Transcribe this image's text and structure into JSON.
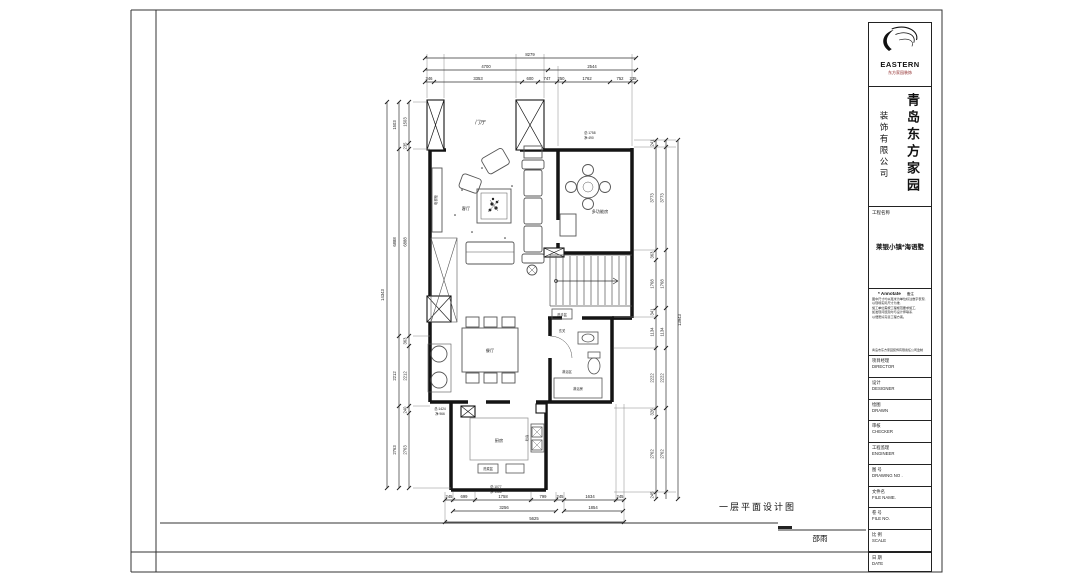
{
  "title_block": {
    "logo": {
      "brand": "EASTERN",
      "sub": "东方家园装饰"
    },
    "company": {
      "name_vertical": "青岛东方家园",
      "type_vertical": "装饰有限公司"
    },
    "project": {
      "label": "工程名称",
      "name": "莱银小镇*海语墅"
    },
    "annotate": {
      "header": "* Annotate",
      "header_right": "备注",
      "lines": [
        "图中尺寸均以毫米为单位标注数字表现,",
        "以现场实际尺寸为准,",
        "施工单位需按工程规范要求施工,",
        "如发现问题及时与设计师联系,",
        "以便更好完善工程方案。"
      ],
      "footer": "青岛市东方家园装饰有限责任公司监制"
    },
    "fields": [
      {
        "zh": "项目经理",
        "en": "DIRECTOR"
      },
      {
        "zh": "设计",
        "en": "DESIGNER"
      },
      {
        "zh": "绘图",
        "en": "DRAWN"
      },
      {
        "zh": "审核",
        "en": "CHECKER"
      },
      {
        "zh": "工程监理",
        "en": "ENGINEER"
      },
      {
        "zh": "图 号",
        "en": "DRAWING NO ."
      },
      {
        "zh": "文件名",
        "en": "FILE NAME."
      },
      {
        "zh": "卷 号",
        "en": "FILE NO."
      },
      {
        "zh": "比 例",
        "en": "SCALE"
      },
      {
        "zh": "日 期",
        "en": "DATE"
      }
    ]
  },
  "footer": {
    "drawing_title": "一层平面设计图",
    "stamp": "邵雨"
  },
  "plan": {
    "rooms": {
      "foyer": "门厅",
      "living": "客厅",
      "multi": "多功能房",
      "dining": "餐厅",
      "kitchen": "厨房",
      "hall": "玄关",
      "shower_zone": "淋浴区",
      "shower_room": "淋浴房"
    },
    "furniture": {
      "tv_cabinet": "电视柜",
      "basin": "洗手盆",
      "sink": "洗菜盆",
      "stove": "灶台"
    },
    "notes": {
      "tr1": "总:1758",
      "tr2": "净:490",
      "kl1": "总:1424",
      "kl2": "净:966",
      "kb1": "总:1077",
      "kb2": "净:1366"
    },
    "dims": {
      "top_total": "8279",
      "top_mid": [
        "4700",
        "2544"
      ],
      "top_inner": [
        "346",
        "3353",
        "600",
        "747",
        "250",
        "1762",
        "752",
        "235"
      ],
      "left_total": "14343",
      "left_mid": [
        "1503",
        "6888",
        "2212",
        "2763"
      ],
      "left_inner": [
        "1503",
        "235",
        "6888",
        "363",
        "2212",
        "240",
        "2763"
      ],
      "right_total": "13943",
      "right_mid": [
        "3773",
        "1768",
        "1134",
        "2222",
        "2762"
      ],
      "right_inner": [
        "241",
        "3773",
        "363",
        "1768",
        "341",
        "1134",
        "2222",
        "326",
        "2762",
        "245"
      ],
      "bottom_inner": [
        "245",
        "699",
        "1758",
        "799",
        "245",
        "1634",
        "245"
      ],
      "bottom_mid": [
        "3256",
        "1854"
      ],
      "bottom_total": "5625"
    }
  }
}
